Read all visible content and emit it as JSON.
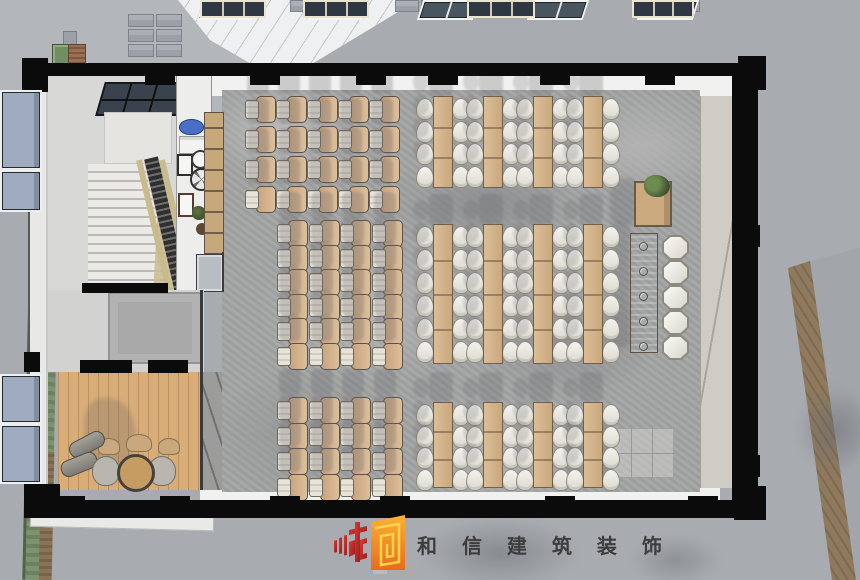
{
  "meta": {
    "scene": "dining-hall-floor-plan-rendering",
    "view": "top-down"
  },
  "watermark": {
    "company": "和信建筑装饰",
    "display_text": "和 信 建 筑 装 饰",
    "logo_red": "#c2272d",
    "logo_orange_light": "#f9b234",
    "logo_orange_dark": "#e96b1c",
    "text_color": "#3d3d3d"
  },
  "palette": {
    "ground": "#a8abaf",
    "roof": "#b3b6ba",
    "wall": "#0b0b0b",
    "floor_gray": "#a3a4a4",
    "wood_table": "#d2b28c",
    "tan_chair": "#d4b492",
    "white_chair": "#ecebe5",
    "glass_blue": "#9fabbe",
    "glass_dark": "#49555f",
    "lounge_wood": "#d9ad78",
    "hedge_green": "#7d9370",
    "path_brown": "#8f7a5e"
  },
  "floorplan": {
    "tablet_chair_blocks": [
      {
        "x": 245,
        "y": 96,
        "cols": 5,
        "rows": 4,
        "pitch_x": 31,
        "pitch_y": 30
      },
      {
        "x": 277,
        "y": 220,
        "cols": 4,
        "rows": 6,
        "pitch_x": 31.5,
        "pitch_y": 24.5
      },
      {
        "x": 277,
        "y": 397,
        "cols": 4,
        "rows": 4,
        "pitch_x": 31.5,
        "pitch_y": 25.5
      }
    ],
    "table_blocks": [
      {
        "y": 96,
        "height": 90,
        "chair_rows": 4,
        "chair_pitch": 22.5,
        "table_x": [
          433,
          483,
          533,
          583
        ]
      },
      {
        "y": 224,
        "height": 138,
        "chair_rows": 6,
        "chair_pitch": 23,
        "table_x": [
          433,
          483,
          533,
          583
        ]
      },
      {
        "y": 402,
        "height": 84,
        "chair_rows": 4,
        "chair_pitch": 21.5,
        "table_x": [
          433,
          483,
          533,
          583
        ]
      }
    ],
    "table_width": 18,
    "bar": {
      "x": 630,
      "y": 233,
      "width": 26,
      "height": 118,
      "stools": 5,
      "stool_pitch": 25,
      "stool_x": 662,
      "decor_dots": 5
    },
    "plant_stand": {
      "x": 634,
      "y": 181
    },
    "top_clerestory_windows_x": [
      200,
      310,
      420,
      530,
      640
    ],
    "top_column_blocks_x": [
      145,
      250,
      356,
      428,
      540,
      645
    ],
    "bottom_column_blocks_x": [
      55,
      160,
      270,
      380,
      545,
      688
    ],
    "bottom_windows": [
      {
        "x": 200,
        "w": 62
      },
      {
        "x": 303,
        "w": 62
      },
      {
        "x": 467,
        "w": 64
      },
      {
        "x": 632,
        "w": 58
      }
    ],
    "right_windows": [
      {
        "y": 90,
        "h": 76
      },
      {
        "y": 170,
        "h": 38
      },
      {
        "y": 374,
        "h": 46
      },
      {
        "y": 424,
        "h": 56
      }
    ],
    "counts": {
      "tablet_chairs": 60,
      "long_tables": 12,
      "dining_chairs": 112,
      "bar_stools": 5
    }
  }
}
